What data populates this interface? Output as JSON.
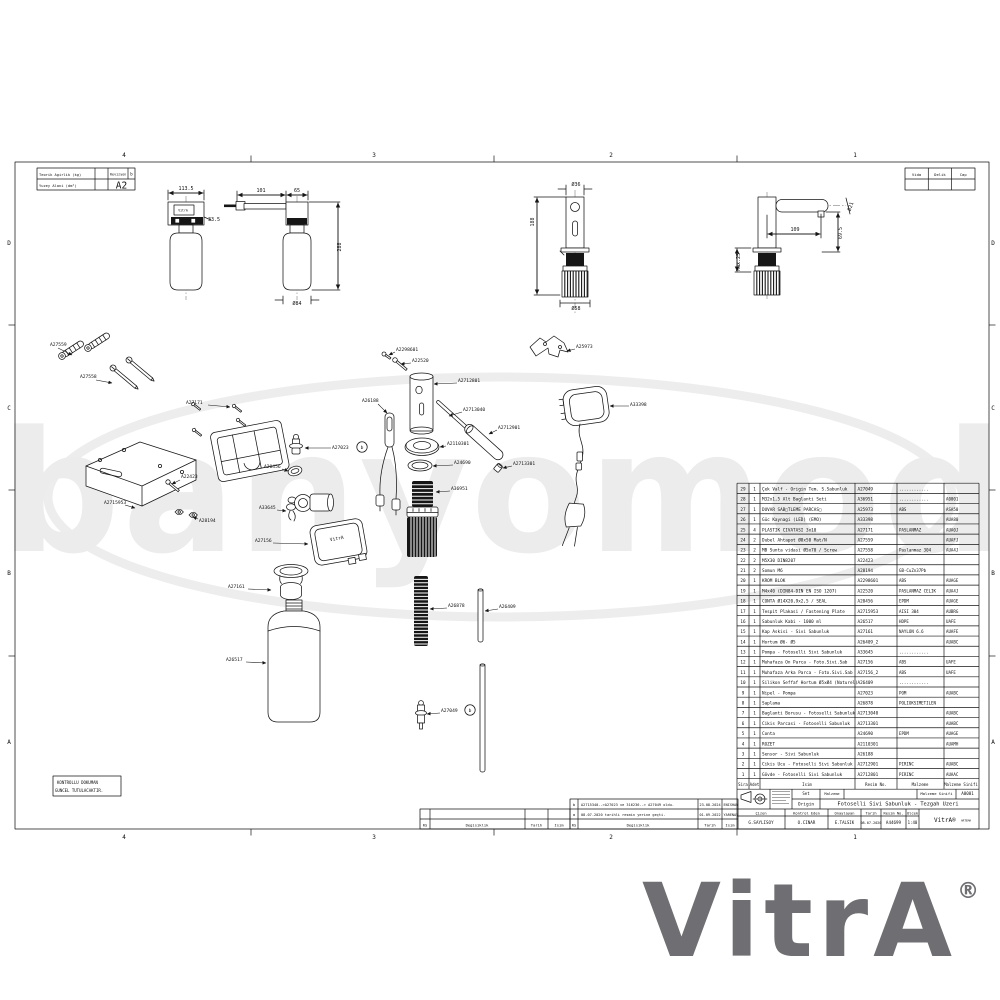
{
  "watermark": {
    "text": "banyomoda"
  },
  "brand": {
    "logo": "VitrA",
    "registered": "®",
    "artema": "ARTEMA"
  },
  "frame": {
    "zones_top": [
      "4",
      "3",
      "2",
      "1"
    ],
    "zones_top_x": [
      124,
      374,
      611,
      855
    ],
    "zones_side": [
      "D",
      "C",
      "B",
      "A"
    ],
    "zones_side_y": [
      243,
      408,
      573,
      742
    ]
  },
  "info_table": {
    "weight_label": "Teorik Agirlik (kg)",
    "area_label": "Yuzey Alani (dm²)",
    "revision_label": "Revizyon",
    "revision_value": "b",
    "sheet_size": "A2"
  },
  "hole_table": {
    "headers": [
      "Vida",
      "Delik",
      "Cap"
    ]
  },
  "control_note": {
    "line1": "KONTROLLU DOKUMAN",
    "line2": "GUNCEL TUTULACAKTIR."
  },
  "device_labels": [
    {
      "t": "VitrA",
      "x": 183,
      "y": 211.5,
      "s": 3.2
    },
    {
      "t": "VitrA",
      "x": 337,
      "y": 540,
      "s": 4.6,
      "r": -10
    }
  ],
  "dimensions": [
    {
      "t": "113.5",
      "x": 186,
      "y": 190
    },
    {
      "t": "33.5",
      "x": 214,
      "y": 221
    },
    {
      "t": "101",
      "x": 261,
      "y": 192
    },
    {
      "t": "65",
      "x": 297,
      "y": 192
    },
    {
      "t": "288",
      "x": 341,
      "y": 247,
      "r": -90
    },
    {
      "t": "Ø84",
      "x": 297,
      "y": 305
    },
    {
      "t": "Ø36",
      "x": 576,
      "y": 186
    },
    {
      "t": "188",
      "x": 534,
      "y": 222,
      "r": -90
    },
    {
      "t": "Ø58",
      "x": 576,
      "y": 310
    },
    {
      "t": "109",
      "x": 795,
      "y": 231
    },
    {
      "t": "69.5",
      "x": 842,
      "y": 233,
      "r": -90
    },
    {
      "t": "Ø21",
      "x": 852,
      "y": 207,
      "r": -70
    },
    {
      "t": "Max.25",
      "x": 740,
      "y": 262,
      "r": -90
    }
  ],
  "part_labels": [
    {
      "t": "A27559",
      "x": 50,
      "y": 346,
      "lx": 58,
      "ly": 348,
      "tx": 72,
      "ty": 355
    },
    {
      "t": "A27558",
      "x": 80,
      "y": 378,
      "lx": 96,
      "ly": 380,
      "tx": 112,
      "ty": 383
    },
    {
      "t": "A27171",
      "x": 186,
      "y": 404,
      "lx": 208,
      "ly": 405,
      "tx": 230,
      "ty": 407
    },
    {
      "t": "A2298601",
      "x": 396,
      "y": 351,
      "lx": 395,
      "ly": 352,
      "tx": 389,
      "ty": 355
    },
    {
      "t": "A22520",
      "x": 412,
      "y": 362,
      "lx": 411,
      "ly": 363,
      "tx": 401,
      "ty": 364
    },
    {
      "t": "A2712801",
      "x": 458,
      "y": 382,
      "lx": 457,
      "ly": 383,
      "tx": 434,
      "ty": 384
    },
    {
      "t": "A26188",
      "x": 362,
      "y": 402,
      "lx": 378,
      "ly": 404,
      "tx": 387,
      "ty": 413
    },
    {
      "t": "A2713040",
      "x": 463,
      "y": 411,
      "lx": 462,
      "ly": 412,
      "tx": 449,
      "ty": 416
    },
    {
      "t": "A2712901",
      "x": 498,
      "y": 429,
      "lx": 497,
      "ly": 430,
      "tx": 489,
      "ty": 434
    },
    {
      "t": "A2110301",
      "x": 447,
      "y": 445,
      "lx": 446,
      "ly": 446,
      "tx": 440,
      "ty": 447
    },
    {
      "t": "A24690",
      "x": 454,
      "y": 464,
      "lx": 453,
      "ly": 465,
      "tx": 433,
      "ty": 466
    },
    {
      "t": "A2713301",
      "x": 513,
      "y": 465,
      "lx": 512,
      "ly": 466,
      "tx": 503,
      "ty": 468
    },
    {
      "t": "A27023",
      "x": 332,
      "y": 449,
      "lx": 331,
      "ly": 448,
      "tx": 305,
      "ty": 448,
      "balloon": "b",
      "bx": 362,
      "by": 447
    },
    {
      "t": "A20456",
      "x": 264,
      "y": 468,
      "lx": 282,
      "ly": 469,
      "tx": 288,
      "ty": 471
    },
    {
      "t": "A22423",
      "x": 181,
      "y": 478,
      "lx": 180,
      "ly": 480,
      "tx": 172,
      "ty": 484
    },
    {
      "t": "A2715953",
      "x": 104,
      "y": 504,
      "lx": 125,
      "ly": 505,
      "tx": 135,
      "ty": 508
    },
    {
      "t": "A28194",
      "x": 199,
      "y": 522,
      "lx": 198,
      "ly": 519,
      "tx": 193,
      "ty": 517
    },
    {
      "t": "A33645",
      "x": 259,
      "y": 509,
      "lx": 277,
      "ly": 510,
      "tx": 286,
      "ty": 511
    },
    {
      "t": "A27156",
      "x": 255,
      "y": 542,
      "lx": 273,
      "ly": 543,
      "tx": 308,
      "ty": 544
    },
    {
      "t": "A36951",
      "x": 451,
      "y": 490,
      "lx": 450,
      "ly": 491,
      "tx": 436,
      "ty": 492
    },
    {
      "t": "A33398",
      "x": 630,
      "y": 406,
      "lx": 629,
      "ly": 406,
      "tx": 610,
      "ty": 406
    },
    {
      "t": "A25973",
      "x": 576,
      "y": 348,
      "lx": 575,
      "ly": 349,
      "tx": 567,
      "ty": 351
    },
    {
      "t": "A27161",
      "x": 228,
      "y": 588,
      "lx": 248,
      "ly": 589,
      "tx": 271,
      "ty": 590
    },
    {
      "t": "A26517",
      "x": 226,
      "y": 661,
      "lx": 246,
      "ly": 662,
      "tx": 266,
      "ty": 663
    },
    {
      "t": "A26878",
      "x": 448,
      "y": 607,
      "lx": 447,
      "ly": 608,
      "tx": 430,
      "ty": 609
    },
    {
      "t": "A26409",
      "x": 499,
      "y": 608,
      "lx": 498,
      "ly": 609,
      "tx": 485,
      "ty": 611
    },
    {
      "t": "A27049",
      "x": 441,
      "y": 712,
      "lx": 440,
      "ly": 713,
      "tx": 427,
      "ty": 714,
      "balloon": "b",
      "bx": 470,
      "by": 710
    }
  ],
  "parts_table": {
    "headers": [
      "Sira",
      "Adet",
      "Isim",
      "Resim No.",
      "Malzeme",
      "Malzeme Sinifi"
    ],
    "rows": [
      [
        "29",
        "1",
        "Çek Valf - Origin Tem. S.Sabunluk",
        "A27049",
        "............",
        ""
      ],
      [
        "28",
        "1",
        "M32x1,5 Alt Baglanti Seti",
        "A36951",
        "............",
        "A0001"
      ],
      [
        "27",
        "1",
        "DUVAR SAB□TLEME PARCAS□",
        "A25973",
        "ABS",
        "ASA50"
      ],
      [
        "26",
        "1",
        "Güc Kaynagi (LED) (EMO)",
        "A33398",
        "",
        "AUA80"
      ],
      [
        "25",
        "4",
        "PLASTIK CIVATASI 3x10",
        "A27171",
        "PASLANMAZ",
        "AUA0J"
      ],
      [
        "24",
        "2",
        "Dubel Ahtapot Ø8x50 Mat/N",
        "A27559",
        "",
        "AUAFJ"
      ],
      [
        "23",
        "2",
        "MB Sunta vidasi Ø5x70 / Screw",
        "A27558",
        "Paslanmaz 304",
        "AUA4J"
      ],
      [
        "22",
        "2",
        "M5X30 DIN8207",
        "A22423",
        "",
        ""
      ],
      [
        "21",
        "2",
        "Somun M6",
        "A28194",
        "GB-CuZn37Pb",
        ""
      ],
      [
        "20",
        "1",
        "KROM BLOK",
        "A2298601",
        "ABS",
        "AUAGE"
      ],
      [
        "19",
        "1",
        "M4x40 (DIN84-DIN EN ISO 1207)",
        "A22520",
        "PASLANMAZ CELIK",
        "AUA4J"
      ],
      [
        "18",
        "1",
        "CONTA Ø14X20,9x2,5 / SEAL",
        "A20456",
        "EPDM",
        "AUAGE"
      ],
      [
        "17",
        "1",
        "Tespit Plakasi / Fastening Plate",
        "A2715953",
        "AISI 304",
        "AUBRG"
      ],
      [
        "16",
        "1",
        "Sabunluk Kabi - 1000 ml",
        "A26517",
        "HDPE",
        "UAFE"
      ],
      [
        "15",
        "1",
        "Kap Askisi - Sivi Sabunluk",
        "A27161",
        "NAYLON 6.6",
        "AUAFE"
      ],
      [
        "14",
        "1",
        "Hortum Ø6- Ø5",
        "A26409_2",
        "",
        "AUABC"
      ],
      [
        "13",
        "1",
        "Pompa - Fotoselli Sivi Sabunluk",
        "A33645",
        "............",
        ""
      ],
      [
        "12",
        "1",
        "Muhafaza On Parca - Foto.Sivi.Sab",
        "A27156",
        "ABS",
        "UAFE"
      ],
      [
        "11",
        "1",
        "Muhafaza Arka Parca - Foto.Sivi.Sab",
        "A27156_2",
        "ABS",
        "UAFE"
      ],
      [
        "10",
        "1",
        "Silikon Seffaf Hortum Ø5xØ4 (Naturel)",
        "A26409",
        "............",
        ""
      ],
      [
        "9",
        "1",
        "Nipel - Pompa",
        "A27023",
        "POM",
        "AUABC"
      ],
      [
        "8",
        "1",
        "Saplama",
        "A26878",
        "POLIOKSIMETILEN",
        ""
      ],
      [
        "7",
        "1",
        "Baglanti Borusu - Fotoselli Sabunluk",
        "A2713040",
        "",
        "AUABC"
      ],
      [
        "6",
        "1",
        "Cikis Parcasi - Fotoselli Sabunluk",
        "A2713301",
        "",
        "AUABC"
      ],
      [
        "5",
        "1",
        "Conta",
        "A24690",
        "EPDM",
        "AUAGE"
      ],
      [
        "4",
        "1",
        "ROZET",
        "A2110301",
        "",
        "AUAMH"
      ],
      [
        "3",
        "1",
        "Sensor - Sivi Sabunluk",
        "A26188",
        "",
        ""
      ],
      [
        "2",
        "1",
        "Cikis Ucu - Fotoselli Sivi Sabunluk",
        "A2712901",
        "PIRINC",
        "AUABC"
      ],
      [
        "1",
        "1",
        "Gövde - Fotoselli Sivi Sabunluk",
        "A2712801",
        "PIRINC",
        "AUAAC"
      ]
    ]
  },
  "revision_table": {
    "headers": [
      "RS",
      "Degisiklik",
      "Tarih",
      "Isim"
    ],
    "rows": [
      {
        "rs": "b",
        "change": "A2715340-->A27023 ve 316236--> A27049 oldu.",
        "date": "23.08.2024",
        "name": "ENISHAN"
      },
      {
        "rs": "a",
        "change": "08.07.2020 tarihli resmin yerine geçti.",
        "date": "01.09.2022",
        "name": "YARENAV"
      }
    ]
  },
  "title_block": {
    "set_label": "Set",
    "malzeme_label": "Malzeme",
    "material_class_label": "Malzeme Sinifi",
    "material_class": "A0001",
    "origin": "Origin",
    "title": "Fotoselli Sivi Sabunluk - Tezgah Uzeri",
    "cizen_label": "Çizen",
    "kontrol_label": "Kontrol Eden",
    "onay_label": "Onaylayan",
    "tarih_label": "Tarih",
    "resim_label": "Resim No.",
    "olcek_label": "Olcek",
    "cizen": "G.SAYLISOY",
    "kontrol": "O.CINAR",
    "onay": "E.TALSIK",
    "tarih": "08.07.2020",
    "resim_no": "A44699",
    "olcek": "1:40"
  }
}
